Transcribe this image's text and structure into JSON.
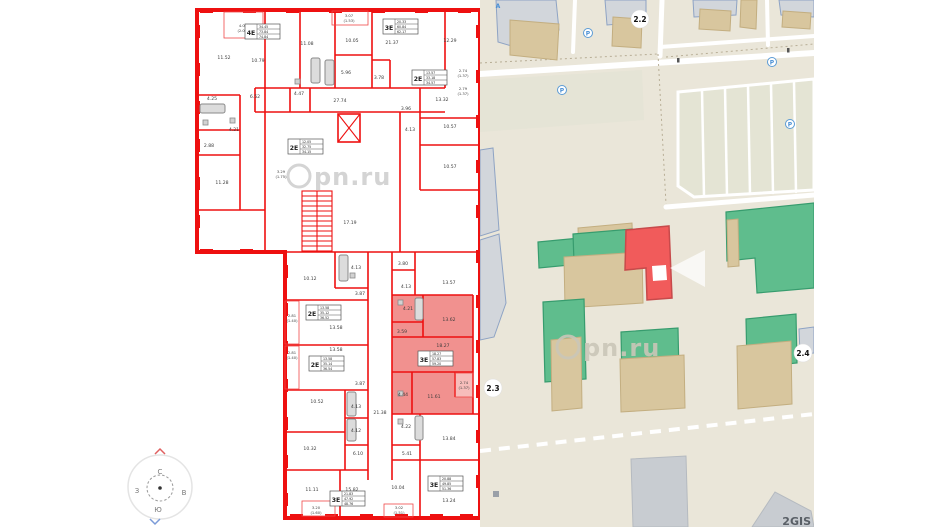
{
  "watermark": {
    "text": "pn.ru"
  },
  "compass": {
    "n": "С",
    "s": "Ю",
    "w": "З",
    "e": "В"
  },
  "map": {
    "labels": {
      "b22": "2.2",
      "b23": "2.3",
      "b24": "2.4"
    },
    "logo": "2GIS",
    "parking_letter": "P",
    "stop_letter": "А"
  },
  "plan": {
    "tables": {
      "t4e": {
        "type": "4Е",
        "a": "34.45",
        "b": "73.84",
        "c": "74.84"
      },
      "t3ea": {
        "type": "3Е",
        "a": "20.33",
        "b": "60.84",
        "c": "62.17"
      },
      "t2ea": {
        "type": "2Е",
        "a": "12.05",
        "b": "32.75",
        "c": "34.15"
      },
      "t2eb": {
        "type": "2Е",
        "a": "13.57",
        "b": "33.18",
        "c": "34.57"
      },
      "t2ec": {
        "type": "2Е",
        "a": "13.58",
        "b": "35.12",
        "c": "36.52"
      },
      "t2ed": {
        "type": "2Е",
        "a": "13.58",
        "b": "35.14",
        "c": "36.54"
      },
      "t3ep": {
        "type": "3Е",
        "a": "18.27",
        "b": "57.83",
        "c": "59.20"
      },
      "t3ec": {
        "type": "3Е",
        "a": "21.83",
        "b": "47.92",
        "c": "48.76"
      },
      "t3ed": {
        "type": "3Е",
        "a": "20.88",
        "b": "49.85",
        "c": "51.36"
      }
    },
    "areas": {
      "t_balc": "4.02",
      "t_balc2": "(2.01)",
      "r1152": "11.52",
      "r425": "4.25",
      "r288": "2.88",
      "r1128": "11.28",
      "r1079": "10.79",
      "r652": "6.52",
      "r421": "4.21",
      "r447": "4.47",
      "r1108": "11.08",
      "r596": "5.96",
      "r378": "3.78",
      "r1005": "10.05",
      "t_balcm": "3.07",
      "t_balcm2": "(1.53)",
      "r2137": "21.37",
      "r1229": "12.29",
      "balc_r1": "2.74",
      "balc_r1b": "(1.37)",
      "balc_r2": "2.79",
      "balc_r2b": "(1.37)",
      "r2774": "27.74",
      "r1332": "13.32",
      "r396": "3.96",
      "r1057a": "10.57",
      "r413a": "4.13",
      "r1057b": "10.57",
      "r1719": "17.19",
      "balc_s": "3.29",
      "balc_s2": "(1.75)",
      "b1012": "10.12",
      "b413a": "4.13",
      "b387a": "3.87",
      "b380": "3.80",
      "b413b": "4.13",
      "b1357": "13.57",
      "balc_l1": "2.81",
      "balc_l1b": "(1.40)",
      "b1358a": "13.58",
      "b421": "4.21",
      "b1362": "13.62",
      "b359": "3.59",
      "balc_l2": "2.81",
      "balc_l2b": "(1.40)",
      "b1358b": "13.58",
      "b1827": "18.27",
      "b387b": "3.87",
      "b1052": "10.52",
      "b413c": "4.13",
      "b444": "4.44",
      "b1161": "11.61",
      "balc_p": "2.74",
      "balc_pb": "(1.37)",
      "b2138": "21.38",
      "b1032": "10.32",
      "b412": "4.12",
      "b422": "4.22",
      "b1384": "13.84",
      "b610": "6.10",
      "b541": "5.41",
      "b1111": "11.11",
      "b1582": "15.82",
      "b1004": "10.04",
      "b1324": "13.24",
      "balc_b1": "3.20",
      "balc_b1b": "(1.60)",
      "balc_b2": "3.02",
      "balc_b2b": "(1.51)"
    }
  }
}
